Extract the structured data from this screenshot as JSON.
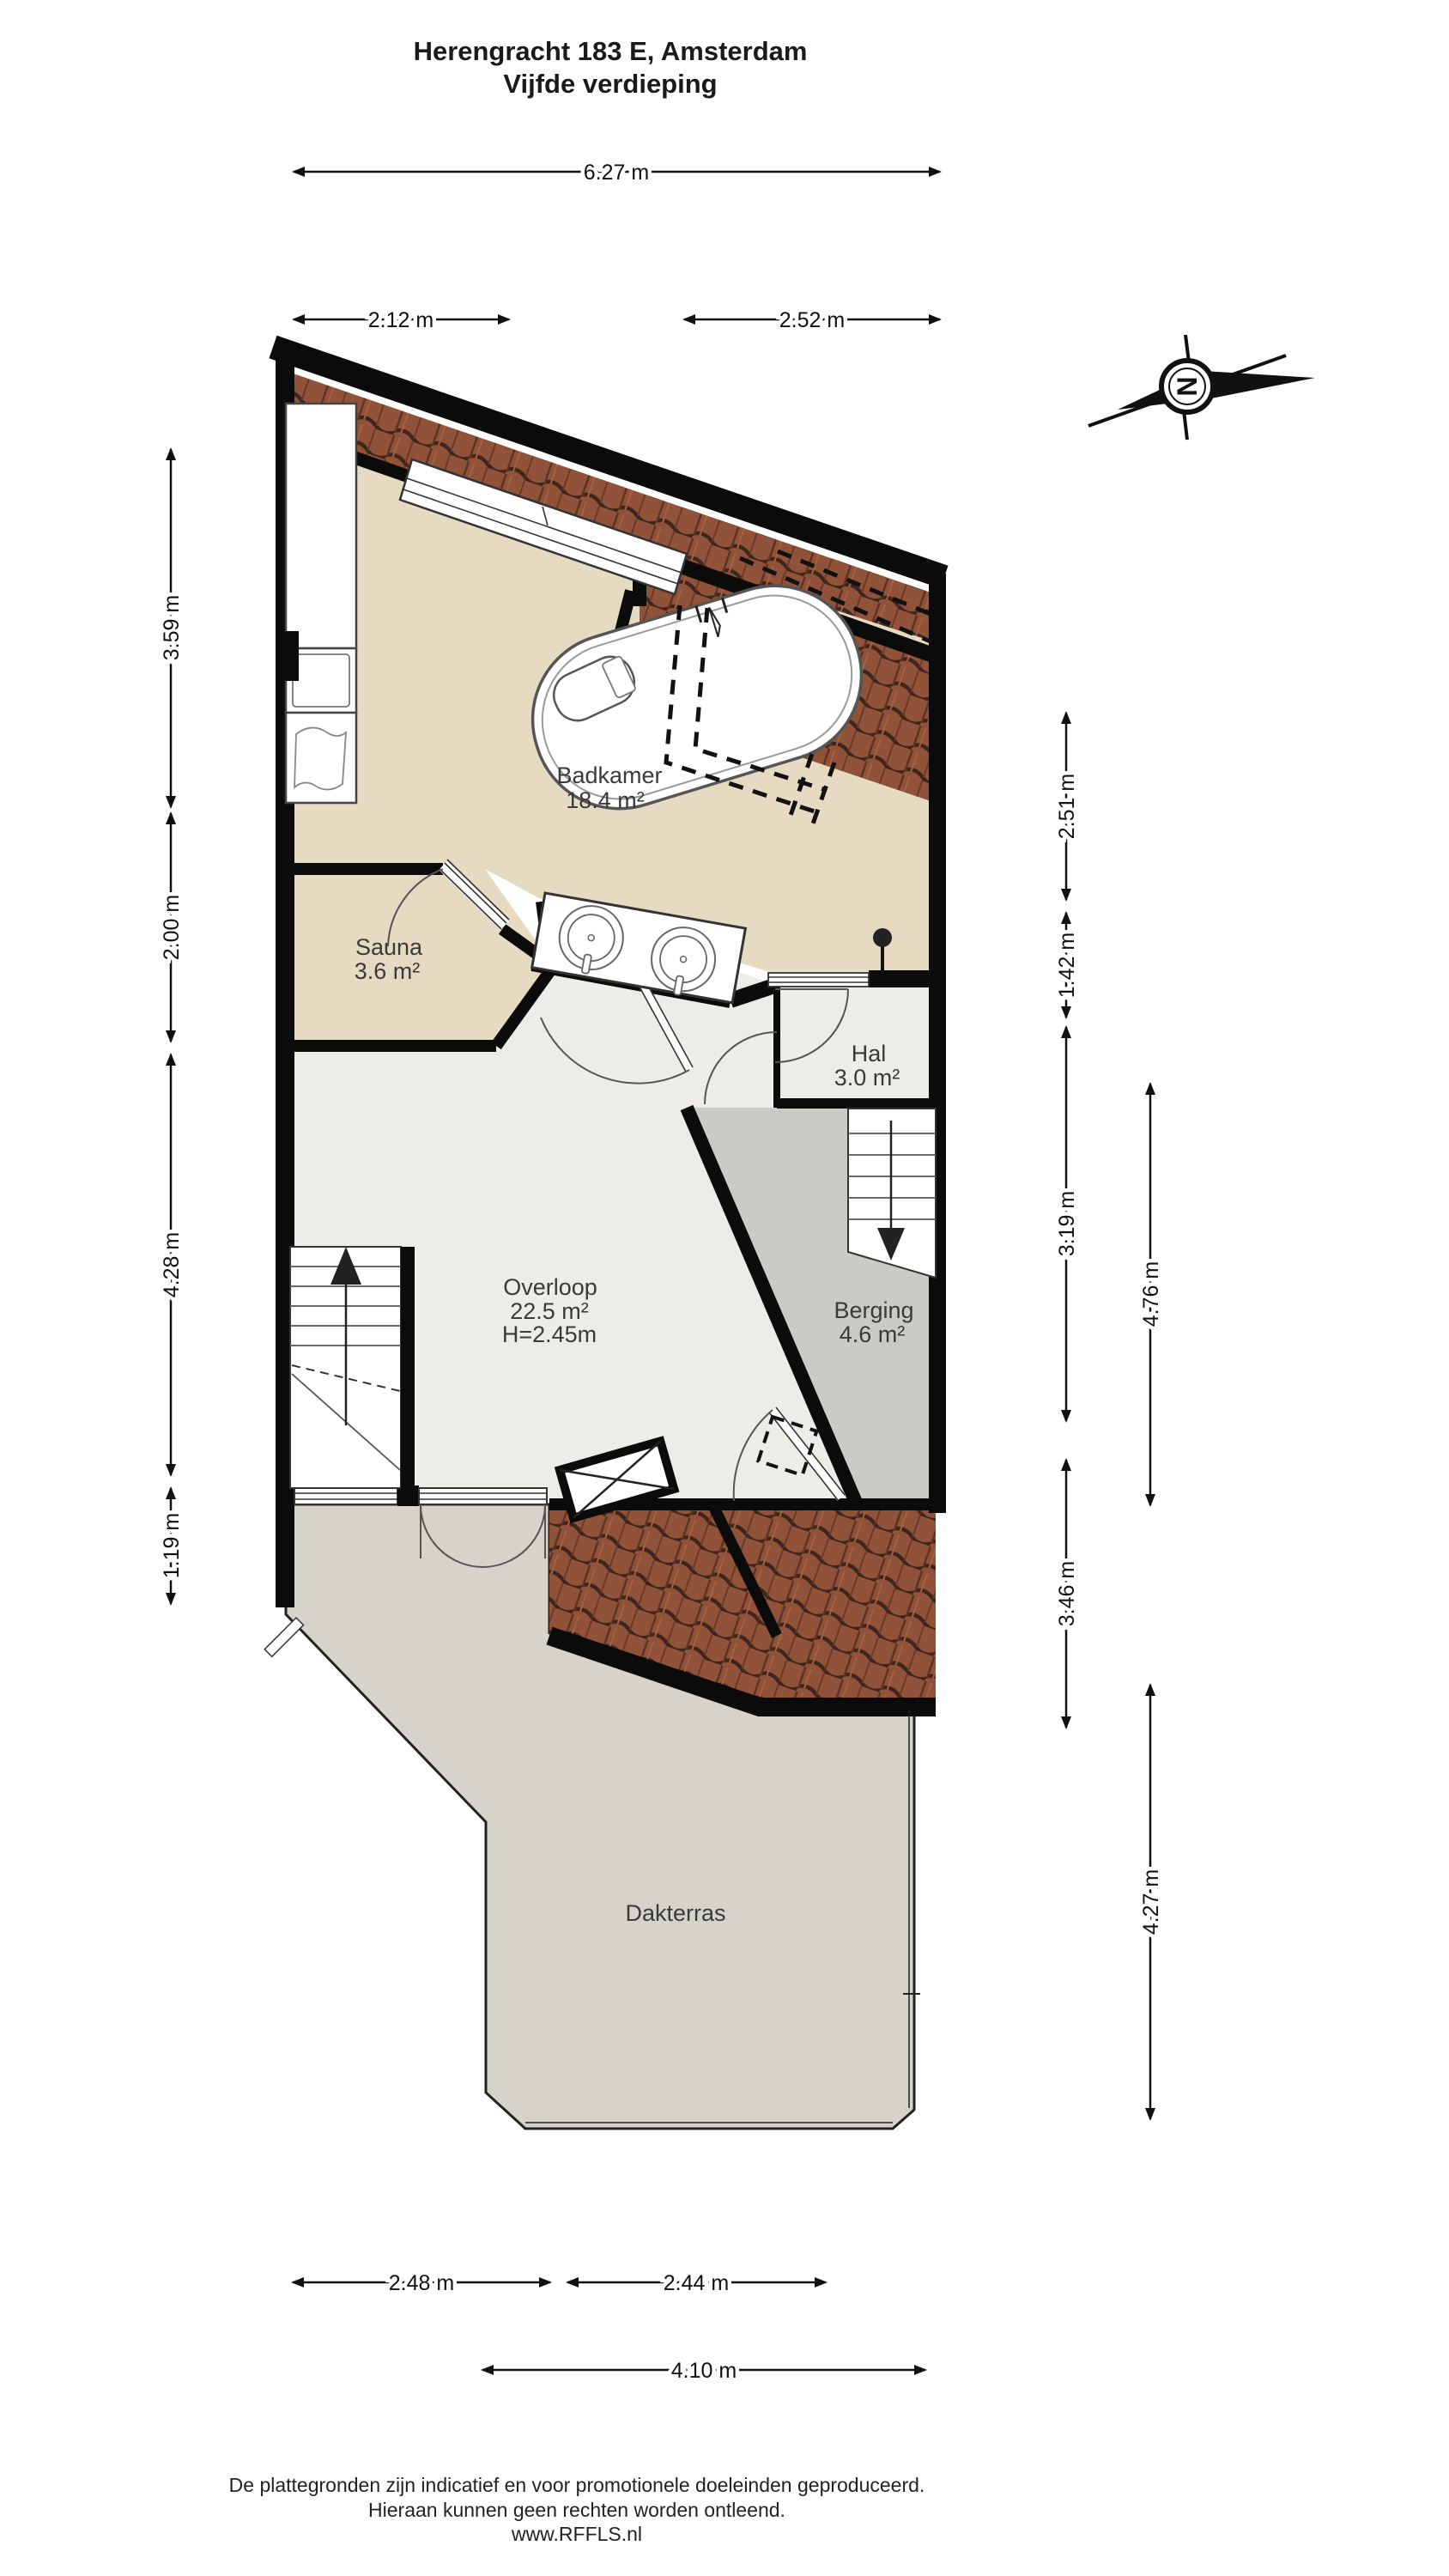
{
  "title": {
    "line1": "Herengracht 183 E, Amsterdam",
    "line2": "Vijfde verdieping"
  },
  "rooms": {
    "badkamer": {
      "name": "Badkamer",
      "area": "18.4 m²"
    },
    "sauna": {
      "name": "Sauna",
      "area": "3.6 m²"
    },
    "hal": {
      "name": "Hal",
      "area": "3.0 m²"
    },
    "overloop": {
      "name": "Overloop",
      "area": "22.5 m²",
      "height": "H=2.45m"
    },
    "berging": {
      "name": "Berging",
      "area": "4.6 m²"
    },
    "dakterras": {
      "name": "Dakterras"
    }
  },
  "dimensions": {
    "top_total": "6.27 m",
    "top_left": "2.12 m",
    "top_right": "2.52 m",
    "left_1": "3.59 m",
    "left_2": "2.00 m",
    "left_3": "4.28 m",
    "left_4": "1.19 m",
    "right_1": "2.51 m",
    "right_2": "1.42 m",
    "right_3": "3.19 m",
    "right_4": "3.46 m",
    "right_outer_1": "4.76 m",
    "right_outer_2": "4.27 m",
    "bottom_left": "2.48 m",
    "bottom_right": "2.44 m",
    "bottom_total": "4.10 m"
  },
  "compass": {
    "letter": "N"
  },
  "footer": {
    "line1": "De plattegronden zijn indicatief en voor promotionele doeleinden geproduceerd.",
    "line2": "Hieraan kunnen geen rechten worden ontleend.",
    "line3": "www.RFFLS.nl"
  },
  "colors": {
    "wall": "#0b0b0b",
    "floor_bath": "#e6dac3",
    "floor_land": "#edece6",
    "floor_storage": "#c8ccc4",
    "floor_terrace": "#d5d3ca",
    "roof_tile": "#91523a",
    "roof_tile_dark": "#3f261c"
  }
}
